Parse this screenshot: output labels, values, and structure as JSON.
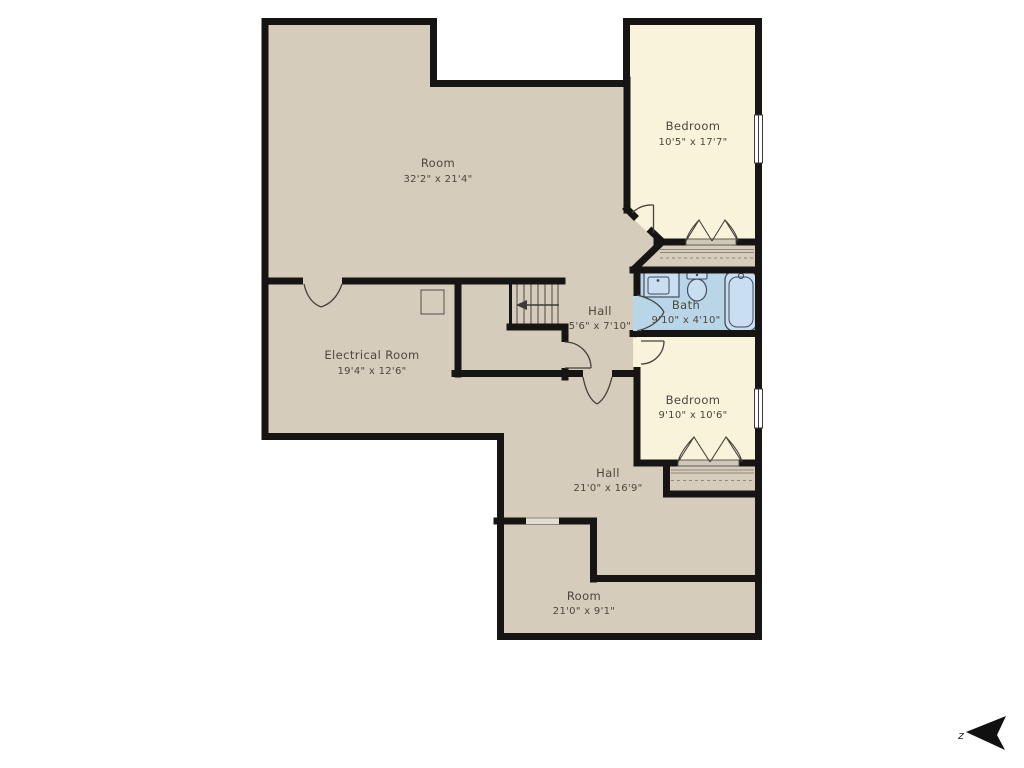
{
  "floor_plan": {
    "background": "#ffffff",
    "colors": {
      "floor_tan": "#d5ccbb",
      "bedroom_cream": "#faf3db",
      "bath_blue": "#b9d6e9",
      "wall_black": "#171513",
      "label_text": "#4e463c"
    },
    "rooms": [
      {
        "id": "room-main",
        "name": "Room",
        "dims": "32'2\" x 21'4\""
      },
      {
        "id": "bedroom-1",
        "name": "Bedroom",
        "dims": "10'5\" x 17'7\""
      },
      {
        "id": "bath",
        "name": "Bath",
        "dims": "9'10\" x 4'10\""
      },
      {
        "id": "hall-small",
        "name": "Hall",
        "dims": "5'6\" x 7'10\""
      },
      {
        "id": "electrical-room",
        "name": "Electrical Room",
        "dims": "19'4\" x 12'6\""
      },
      {
        "id": "bedroom-2",
        "name": "Bedroom",
        "dims": "9'10\" x 10'6\""
      },
      {
        "id": "hall-main",
        "name": "Hall",
        "dims": "21'0\" x 16'9\""
      },
      {
        "id": "room-bottom",
        "name": "Room",
        "dims": "21'0\" x 9'1\""
      }
    ],
    "compass": {
      "label": "z"
    },
    "symbols": [
      "stairs",
      "stair-direction-arrow",
      "bathtub",
      "toilet",
      "sink-vanity",
      "swing-door",
      "bifold-closet-doors",
      "closet-rod-dashed",
      "window",
      "electrical-panel",
      "north-arrow"
    ]
  }
}
